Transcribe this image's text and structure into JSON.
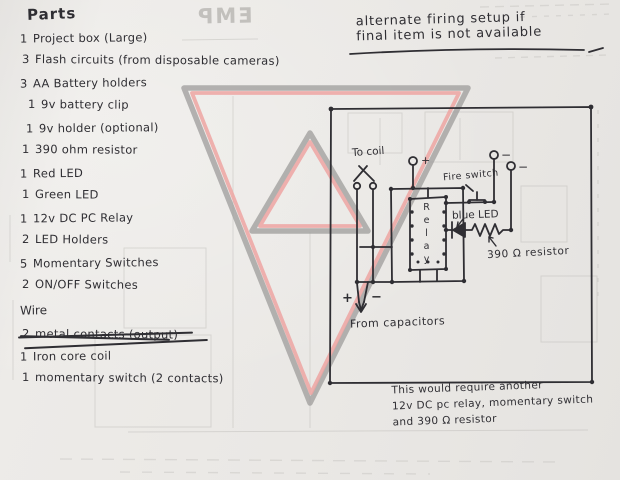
{
  "document": {
    "heading": "Parts",
    "parts": {
      "items": [
        {
          "qty": "1",
          "name": "Project box (Large)"
        },
        {
          "qty": "3",
          "name": "Flash circuits  (from disposable cameras)"
        },
        {
          "qty": "3",
          "name": "AA Battery holders"
        },
        {
          "qty": "1",
          "name": "9v battery clip"
        },
        {
          "qty": "1",
          "name": "9v holder (optional)"
        },
        {
          "qty": "1",
          "name": "390 ohm resistor"
        },
        {
          "qty": "1",
          "name": "Red LED"
        },
        {
          "qty": "1",
          "name": "Green LED"
        },
        {
          "qty": "1",
          "name": "12v DC PC Relay"
        },
        {
          "qty": "2",
          "name": "LED Holders"
        },
        {
          "qty": "5",
          "name": "Momentary Switches"
        },
        {
          "qty": "2",
          "name": "ON/OFF Switches"
        }
      ],
      "wire_heading": "Wire",
      "crossed_out": {
        "qty": "2",
        "name": "metal contacts (output)"
      },
      "extra": [
        {
          "qty": "1",
          "name": "Iron core coil"
        },
        {
          "qty": "1",
          "name": "momentary switch (2 contacts)"
        }
      ]
    },
    "top_note": {
      "line1": "alternate firing setup if",
      "line2": "final item is not available"
    },
    "bottom_note": {
      "line1": "This would require another",
      "line2": "12v DC pc relay, momentary switch",
      "line3": "and 390 Ω resistor"
    }
  },
  "circuit": {
    "to_coil_label": "To coil",
    "plus_terminal": "+",
    "minus_terminal_1": "−",
    "minus_terminal_2": "−",
    "fire_switch_label": "Fire switch",
    "blue_led_label": "blue LED",
    "relay_label": "Relay",
    "resistor_label": "390 Ω resistor",
    "plus_bottom": "+",
    "minus_bottom": "−",
    "from_capacitors_label": "From capacitors"
  },
  "bleedthrough": {
    "mirrored_title": "EMP"
  },
  "colors": {
    "ink": "#2f2e33",
    "paper": "#eae8e5",
    "triangle_gray": "#a09f9d",
    "triangle_pink": "#eda5a2",
    "pencil": "#b3b1ad"
  }
}
